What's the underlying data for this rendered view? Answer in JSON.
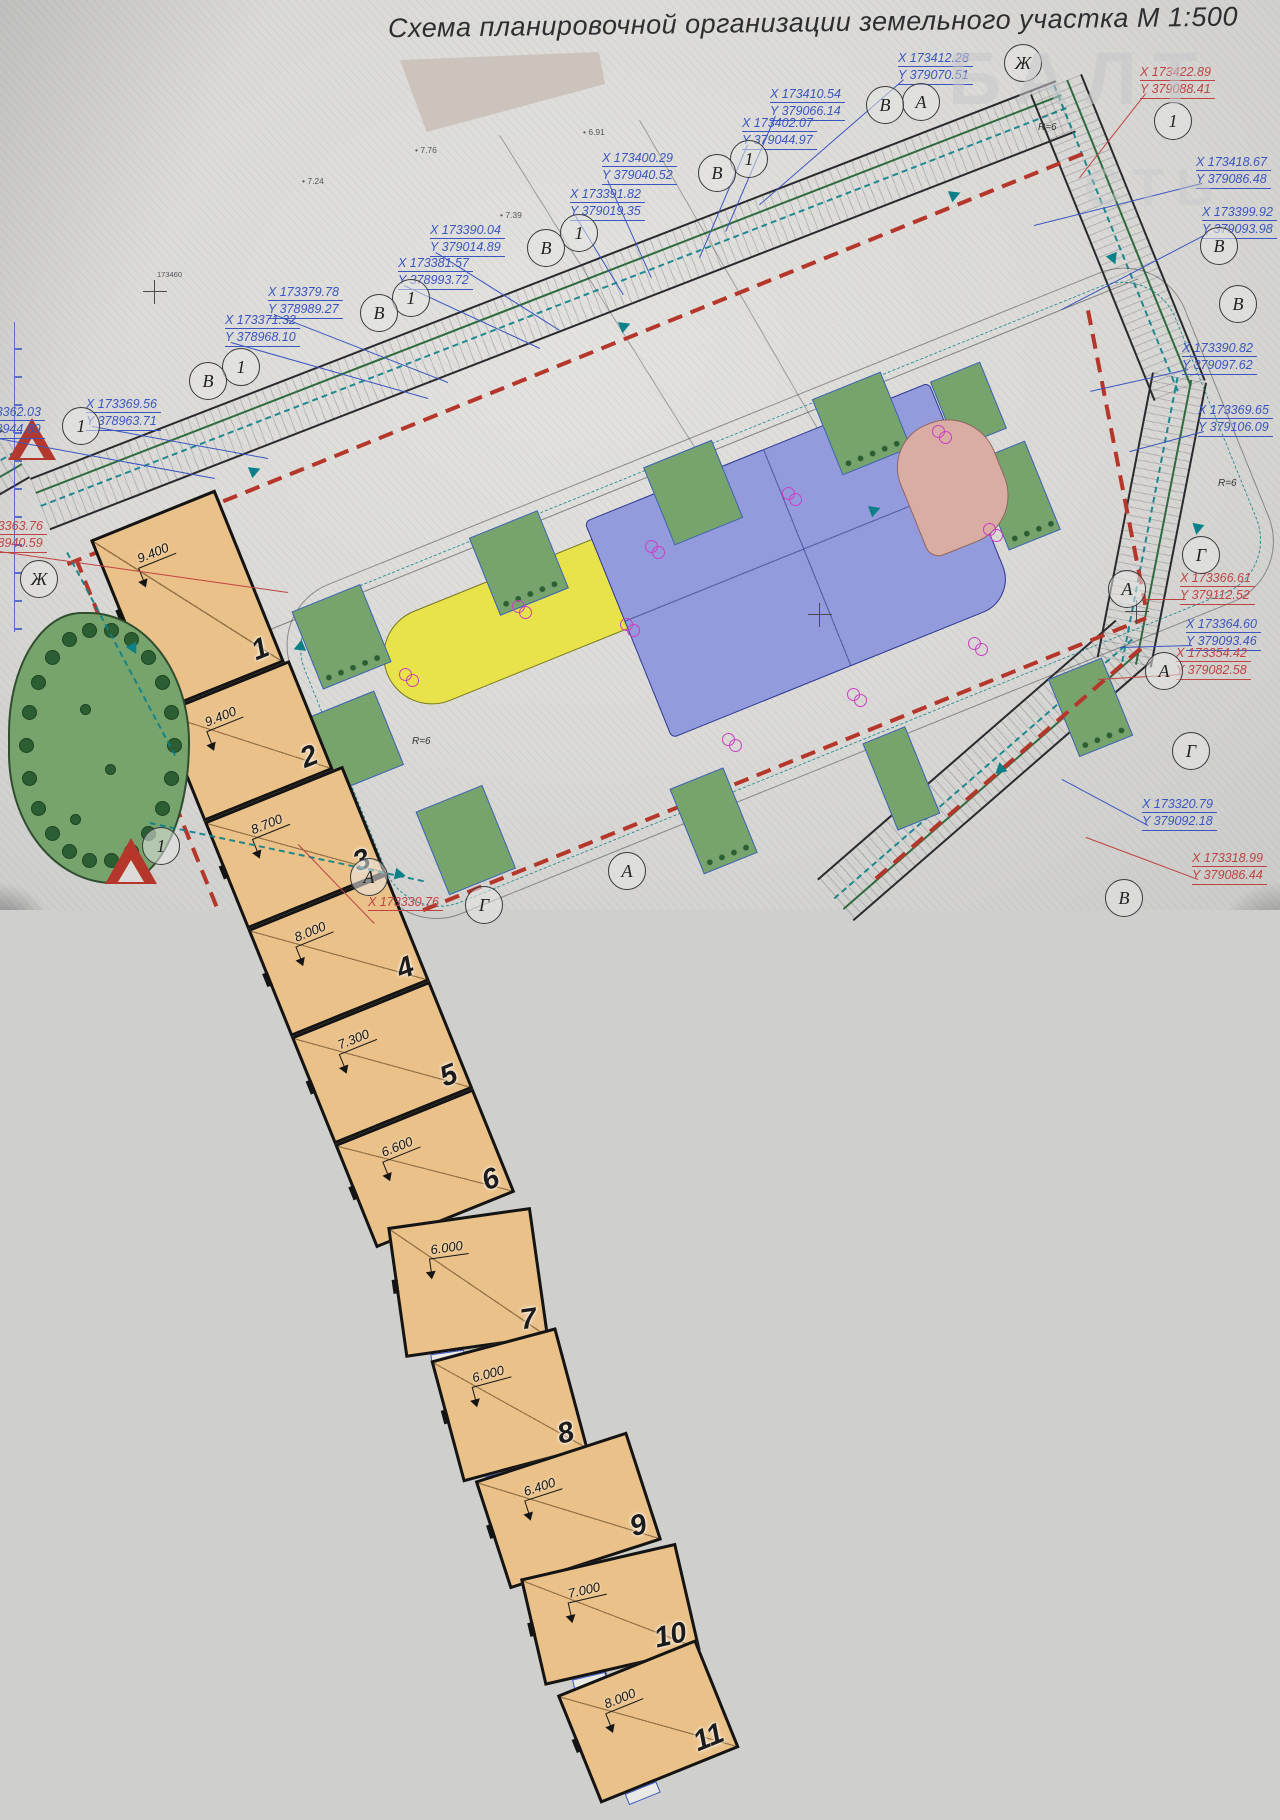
{
  "title": "Схема планировочной организации земельного участка  М 1:500",
  "watermark": {
    "line1": "БАЛТ",
    "line2": "СТЬ"
  },
  "colors": {
    "building_fill": "#eac188",
    "lawn": "#77a46d",
    "parking_blue": "#949bdc",
    "playground_yellow": "#e9e34b",
    "area_pink": "#d9aca4",
    "red_line": "#b5372b",
    "teal": "#0c8089",
    "coord_blue": "#3a55c0",
    "coord_red": "#bf4343"
  },
  "buildings": [
    {
      "num": "1",
      "elev": "9.400",
      "x": -5,
      "y": 180,
      "w": 135,
      "h": 186,
      "rot": 0
    },
    {
      "num": "2",
      "elev": "9.400",
      "x": 10,
      "y": 22,
      "w": 140,
      "h": 118,
      "rot": 0
    },
    {
      "num": "3",
      "elev": "8.700",
      "x": 200,
      "y": 10,
      "w": 150,
      "h": 116,
      "rot": 0
    },
    {
      "num": "4",
      "elev": "8.000",
      "x": 394,
      "y": 8,
      "w": 150,
      "h": 116,
      "rot": 0
    },
    {
      "num": "5",
      "elev": "7.300",
      "x": 583,
      "y": 8,
      "w": 150,
      "h": 116,
      "rot": 0
    },
    {
      "num": "6",
      "elev": "6.600",
      "x": 767,
      "y": 10,
      "w": 150,
      "h": 112,
      "rot": 0
    },
    {
      "num": "7",
      "elev": "6.000",
      "x": 897,
      "y": 60,
      "w": 145,
      "h": 132,
      "rot": 14
    },
    {
      "num": "8",
      "elev": "6.000",
      "x": 910,
      "y": 235,
      "w": 130,
      "h": 126,
      "rot": 7
    },
    {
      "num": "9",
      "elev": "6.400",
      "x": 668,
      "y": 494,
      "w": 160,
      "h": 114,
      "rot": 4
    },
    {
      "num": "10",
      "elev": "7.000",
      "x": 488,
      "y": 494,
      "w": 160,
      "h": 110,
      "rot": 9
    },
    {
      "num": "11",
      "elev": "8.000",
      "x": 281,
      "y": 356,
      "w": 150,
      "h": 117,
      "rot": 0
    }
  ],
  "lawns": [
    {
      "x": 160,
      "y": 142,
      "w": 74,
      "h": 84,
      "dots": true
    },
    {
      "x": 352,
      "y": 140,
      "w": 74,
      "h": 84,
      "dots": true
    },
    {
      "x": 540,
      "y": 140,
      "w": 74,
      "h": 84,
      "dots": false
    },
    {
      "x": 722,
      "y": 140,
      "w": 74,
      "h": 82,
      "dots": true
    },
    {
      "x": 838,
      "y": 168,
      "w": 54,
      "h": 72,
      "dots": false
    },
    {
      "x": 848,
      "y": 258,
      "w": 56,
      "h": 96,
      "dots": true
    },
    {
      "x": 135,
      "y": 246,
      "w": 72,
      "h": 80,
      "dots": false
    },
    {
      "x": 200,
      "y": 374,
      "w": 72,
      "h": 90,
      "dots": false
    },
    {
      "x": 444,
      "y": 448,
      "w": 58,
      "h": 92,
      "dots": true
    },
    {
      "x": 640,
      "y": 478,
      "w": 46,
      "h": 94,
      "dots": false
    },
    {
      "x": 836,
      "y": 488,
      "w": 58,
      "h": 84,
      "dots": true
    }
  ],
  "coordinate_labels": [
    {
      "x_text": "X 173412.28",
      "y_text": "Y 379070.51",
      "color": "blue",
      "lx": 898,
      "ly": 50,
      "px": 760,
      "py": 205
    },
    {
      "x_text": "X 173410.54",
      "y_text": "Y 379066.14",
      "color": "blue",
      "lx": 770,
      "ly": 86,
      "px": 726,
      "py": 232
    },
    {
      "x_text": "X 173402.07",
      "y_text": "Y 379044.97",
      "color": "blue",
      "lx": 742,
      "ly": 115,
      "px": 700,
      "py": 258
    },
    {
      "x_text": "X 173400.29",
      "y_text": "Y 379040.52",
      "color": "blue",
      "lx": 602,
      "ly": 150,
      "px": 652,
      "py": 278
    },
    {
      "x_text": "X 173391.82",
      "y_text": "Y 379019.35",
      "color": "blue",
      "lx": 570,
      "ly": 186,
      "px": 624,
      "py": 295
    },
    {
      "x_text": "X 173390.04",
      "y_text": "Y 379014.89",
      "color": "blue",
      "lx": 430,
      "ly": 222,
      "px": 560,
      "py": 330
    },
    {
      "x_text": "X 173381.57",
      "y_text": "Y 378993.72",
      "color": "blue",
      "lx": 398,
      "ly": 255,
      "px": 540,
      "py": 348
    },
    {
      "x_text": "X 173379.78",
      "y_text": "Y 378989.27",
      "color": "blue",
      "lx": 268,
      "ly": 284,
      "px": 448,
      "py": 382
    },
    {
      "x_text": "X 173371.32",
      "y_text": "Y 378968.10",
      "color": "blue",
      "lx": 225,
      "ly": 312,
      "px": 428,
      "py": 398
    },
    {
      "x_text": "X 173369.56",
      "y_text": "Y 378963.71",
      "color": "blue",
      "lx": 86,
      "ly": 396,
      "px": 268,
      "py": 458
    },
    {
      "x_text": "X 173362.03",
      "y_text": "Y 378944.89",
      "color": "blue",
      "lx": -30,
      "ly": 404,
      "px": 215,
      "py": 478
    },
    {
      "x_text": "X 173363.76",
      "y_text": "Y 378940.59",
      "color": "red",
      "lx": -28,
      "ly": 518,
      "px": 288,
      "py": 592
    },
    {
      "x_text": "X 173422.89",
      "y_text": "Y 379088.41",
      "color": "red",
      "lx": 1140,
      "ly": 64,
      "px": 1080,
      "py": 178
    },
    {
      "x_text": "X 173418.67",
      "y_text": "Y 379086.48",
      "color": "blue",
      "lx": 1196,
      "ly": 154,
      "px": 1034,
      "py": 226
    },
    {
      "x_text": "X 173399.92",
      "y_text": "Y 379093.98",
      "color": "blue",
      "lx": 1202,
      "ly": 204,
      "px": 1062,
      "py": 310
    },
    {
      "x_text": "X 173390.82",
      "y_text": "Y 379097.62",
      "color": "blue",
      "lx": 1182,
      "ly": 340,
      "px": 1090,
      "py": 392
    },
    {
      "x_text": "X 173369.65",
      "y_text": "Y 379106.09",
      "color": "blue",
      "lx": 1198,
      "ly": 402,
      "px": 1130,
      "py": 452
    },
    {
      "x_text": "X 173366.61",
      "y_text": "Y 379112.52",
      "color": "red",
      "lx": 1180,
      "ly": 570,
      "px": 1142,
      "py": 600
    },
    {
      "x_text": "X 173364.60",
      "y_text": "Y 379093.46",
      "color": "blue",
      "lx": 1186,
      "ly": 616,
      "px": 1120,
      "py": 648
    },
    {
      "x_text": "X 173354.42",
      "y_text": "Y 379082.58",
      "color": "red",
      "lx": 1176,
      "ly": 645,
      "px": 1098,
      "py": 680
    },
    {
      "x_text": "X 173320.79",
      "y_text": "Y 379092.18",
      "color": "blue",
      "lx": 1142,
      "ly": 796,
      "px": 1062,
      "py": 780
    },
    {
      "x_text": "X 173318.99",
      "y_text": "Y 379086.44",
      "color": "red",
      "lx": 1192,
      "ly": 850,
      "px": 1086,
      "py": 838
    },
    {
      "x_text": "X 173330.76",
      "y_text": "",
      "color": "red",
      "lx": 368,
      "ly": 894,
      "px": 298,
      "py": 845
    }
  ],
  "axis_circles": [
    {
      "label": "Ж",
      "cx": 1022,
      "cy": 62
    },
    {
      "label": "А",
      "cx": 920,
      "cy": 101
    },
    {
      "label": "В",
      "cx": 884,
      "cy": 104
    },
    {
      "label": "1",
      "cx": 1172,
      "cy": 120
    },
    {
      "label": "1",
      "cx": 748,
      "cy": 158
    },
    {
      "label": "В",
      "cx": 716,
      "cy": 172
    },
    {
      "label": "1",
      "cx": 578,
      "cy": 232
    },
    {
      "label": "В",
      "cx": 545,
      "cy": 247
    },
    {
      "label": "1",
      "cx": 410,
      "cy": 297
    },
    {
      "label": "В",
      "cx": 378,
      "cy": 312
    },
    {
      "label": "1",
      "cx": 240,
      "cy": 366
    },
    {
      "label": "В",
      "cx": 207,
      "cy": 380
    },
    {
      "label": "1",
      "cx": 80,
      "cy": 425
    },
    {
      "label": "Ж",
      "cx": 38,
      "cy": 578
    },
    {
      "label": "В",
      "cx": 1218,
      "cy": 245
    },
    {
      "label": "В",
      "cx": 1237,
      "cy": 303
    },
    {
      "label": "Г",
      "cx": 1200,
      "cy": 554
    },
    {
      "label": "А",
      "cx": 1126,
      "cy": 588
    },
    {
      "label": "А",
      "cx": 1163,
      "cy": 670
    },
    {
      "label": "Г",
      "cx": 1190,
      "cy": 750
    },
    {
      "label": "А",
      "cx": 368,
      "cy": 876
    },
    {
      "label": "А",
      "cx": 626,
      "cy": 870
    },
    {
      "label": "1",
      "cx": 160,
      "cy": 845
    },
    {
      "label": "В",
      "cx": 1123,
      "cy": 897
    },
    {
      "label": "Г",
      "cx": 483,
      "cy": 904
    }
  ],
  "magenta_markers": [
    {
      "x": 932,
      "y": 425
    },
    {
      "x": 782,
      "y": 487
    },
    {
      "x": 645,
      "y": 540
    },
    {
      "x": 620,
      "y": 618
    },
    {
      "x": 512,
      "y": 600
    },
    {
      "x": 847,
      "y": 688
    },
    {
      "x": 722,
      "y": 733
    },
    {
      "x": 968,
      "y": 637
    },
    {
      "x": 983,
      "y": 523
    },
    {
      "x": 399,
      "y": 668
    }
  ],
  "spot_elevations": [
    {
      "v": "7.76",
      "x": 415,
      "y": 145
    },
    {
      "v": "6.91",
      "x": 583,
      "y": 127
    },
    {
      "v": "7.24",
      "x": 302,
      "y": 176
    },
    {
      "v": "7.39",
      "x": 500,
      "y": 210
    }
  ],
  "radius_labels": [
    {
      "text": "R=6",
      "x": 1038,
      "y": 122
    },
    {
      "text": "R=6",
      "x": 1218,
      "y": 478
    },
    {
      "text": "R=6",
      "x": 412,
      "y": 736
    }
  ],
  "grid_crosses": [
    {
      "x": 155,
      "y": 292,
      "label": "173460"
    },
    {
      "x": 1137,
      "y": 612,
      "label": ""
    },
    {
      "x": 820,
      "y": 615,
      "label": ""
    }
  ],
  "park": {
    "tree_count": 22
  }
}
